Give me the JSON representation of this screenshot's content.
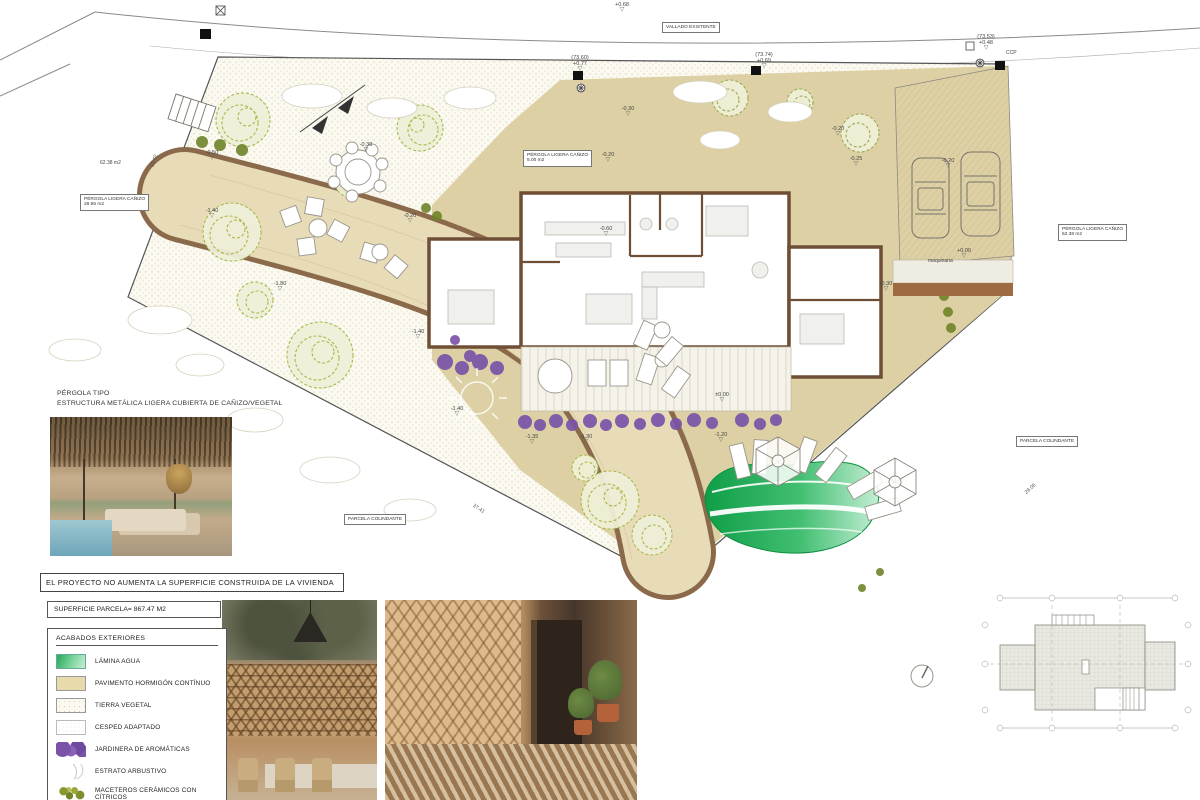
{
  "sheet": {
    "statement": "EL PROYECTO NO AUMENTA LA SUPERFICIE CONSTRUIDA DE LA VIVIENDA",
    "parcel_area": "SUPERFICIE PARCELA= 867.47 M2",
    "pergola_note_title": "PÉRGOLA TIPO",
    "pergola_note_sub": "ESTRUCTURA METÁLICA LIGERA CUBIERTA DE CAÑIZO/VEGETAL"
  },
  "legend": {
    "title": "ACABADOS  EXTERIORES",
    "items": [
      {
        "label": "LÁMINA AGUA",
        "swatch": "agua"
      },
      {
        "label": "PAVIMENTO HORMIGÓN CONTÍNUO",
        "swatch": "pavimento"
      },
      {
        "label": "TIERRA VEGETAL",
        "swatch": "tierra"
      },
      {
        "label": "CESPED ADAPTADO",
        "swatch": "cesped"
      },
      {
        "label": "JARDINERA  DE AROMÁTICAS",
        "swatch": "jardinera"
      },
      {
        "label": "ESTRATO ARBUSTIVO",
        "swatch": "arbustivo"
      },
      {
        "label": "MACETEROS CERÁMICOS CON CÍTRICOS",
        "swatch": "maceteros"
      }
    ]
  },
  "plan": {
    "boxed_labels": [
      {
        "name": "vallado-existente-label",
        "x": 662,
        "y": 22,
        "lines": [
          "VALLADO EXISTENTE"
        ]
      },
      {
        "name": "pergola-ligera-28-label",
        "x": 80,
        "y": 194,
        "lines": [
          "PÉRGOLA LIGERA CAÑIZO",
          "28.96 m2"
        ]
      },
      {
        "name": "pergola-ligera-5-label",
        "x": 523,
        "y": 150,
        "lines": [
          "PÉRGOLA LIGERA CAÑIZO",
          "5.00 m2"
        ]
      },
      {
        "name": "pergola-ligera-62-label",
        "x": 1058,
        "y": 224,
        "lines": [
          "PÉRGOLA LIGERA CAÑIZO",
          "62.38 m2"
        ]
      },
      {
        "name": "parcela-colindante-right-label",
        "x": 1016,
        "y": 436,
        "lines": [
          "PARCELA COLINDANTE"
        ]
      },
      {
        "name": "parcela-colindante-bottom-label",
        "x": 344,
        "y": 514,
        "lines": [
          "PARCELA COLINDANTE"
        ]
      }
    ],
    "free_labels": [
      {
        "name": "area-62-label",
        "x": 100,
        "y": 160,
        "text": "62.38 m2"
      },
      {
        "name": "ccp-label",
        "x": 1006,
        "y": 50,
        "text": "CCP"
      },
      {
        "name": "maquinaria-label",
        "x": 928,
        "y": 258,
        "text": "maquinaria"
      }
    ],
    "level_markers": [
      {
        "x": 622,
        "y": 2,
        "lines": [
          "+0.68"
        ]
      },
      {
        "x": 580,
        "y": 55,
        "lines": [
          "(73.60)",
          "+0.77"
        ]
      },
      {
        "x": 764,
        "y": 52,
        "lines": [
          "(73.74)",
          "+0.69"
        ]
      },
      {
        "x": 986,
        "y": 34,
        "lines": [
          "(73.53)",
          "+0.48"
        ]
      },
      {
        "x": 212,
        "y": 150,
        "lines": [
          "-0.50"
        ]
      },
      {
        "x": 366,
        "y": 142,
        "lines": [
          "-0.30"
        ]
      },
      {
        "x": 628,
        "y": 106,
        "lines": [
          "-0.30"
        ]
      },
      {
        "x": 608,
        "y": 152,
        "lines": [
          "-0.20"
        ]
      },
      {
        "x": 838,
        "y": 126,
        "lines": [
          "-0.20"
        ]
      },
      {
        "x": 856,
        "y": 156,
        "lines": [
          "-0.25"
        ]
      },
      {
        "x": 212,
        "y": 208,
        "lines": [
          "-1.40"
        ]
      },
      {
        "x": 280,
        "y": 281,
        "lines": [
          "-1.80"
        ]
      },
      {
        "x": 410,
        "y": 213,
        "lines": [
          "-0.20"
        ]
      },
      {
        "x": 418,
        "y": 329,
        "lines": [
          "-1.40"
        ]
      },
      {
        "x": 457,
        "y": 406,
        "lines": [
          "-1.40"
        ]
      },
      {
        "x": 532,
        "y": 434,
        "lines": [
          "-1.35"
        ]
      },
      {
        "x": 586,
        "y": 434,
        "lines": [
          "-1.30"
        ]
      },
      {
        "x": 721,
        "y": 432,
        "lines": [
          "-1.20"
        ]
      },
      {
        "x": 606,
        "y": 226,
        "lines": [
          "-0.60"
        ]
      },
      {
        "x": 722,
        "y": 392,
        "lines": [
          "±0.00"
        ]
      },
      {
        "x": 948,
        "y": 158,
        "lines": [
          "-0.20"
        ]
      },
      {
        "x": 964,
        "y": 248,
        "lines": [
          "+0.00"
        ]
      },
      {
        "x": 886,
        "y": 281,
        "lines": [
          "-0.30"
        ]
      }
    ],
    "dimensions": [
      {
        "name": "dim-bottom-left",
        "x": 472,
        "y": 506,
        "rot": 33,
        "text": "37.41"
      },
      {
        "name": "dim-bottom-right",
        "x": 1024,
        "y": 486,
        "rot": -42,
        "text": "29.06"
      },
      {
        "name": "dim-left-edge",
        "x": 148,
        "y": 158,
        "rot": -70,
        "text": "13.42"
      }
    ]
  },
  "colors": {
    "pavement": "#ddd0a4",
    "path_edge_brown": "#8a6a4a",
    "wall_brown": "#6e4f35",
    "pool_green_dark": "#12a64e",
    "pool_green_light": "#c4eed4",
    "jardinera_purple": "#7a53a8",
    "tree_olive": "#a9b544",
    "shrub_dark_olive": "#6f8429"
  }
}
